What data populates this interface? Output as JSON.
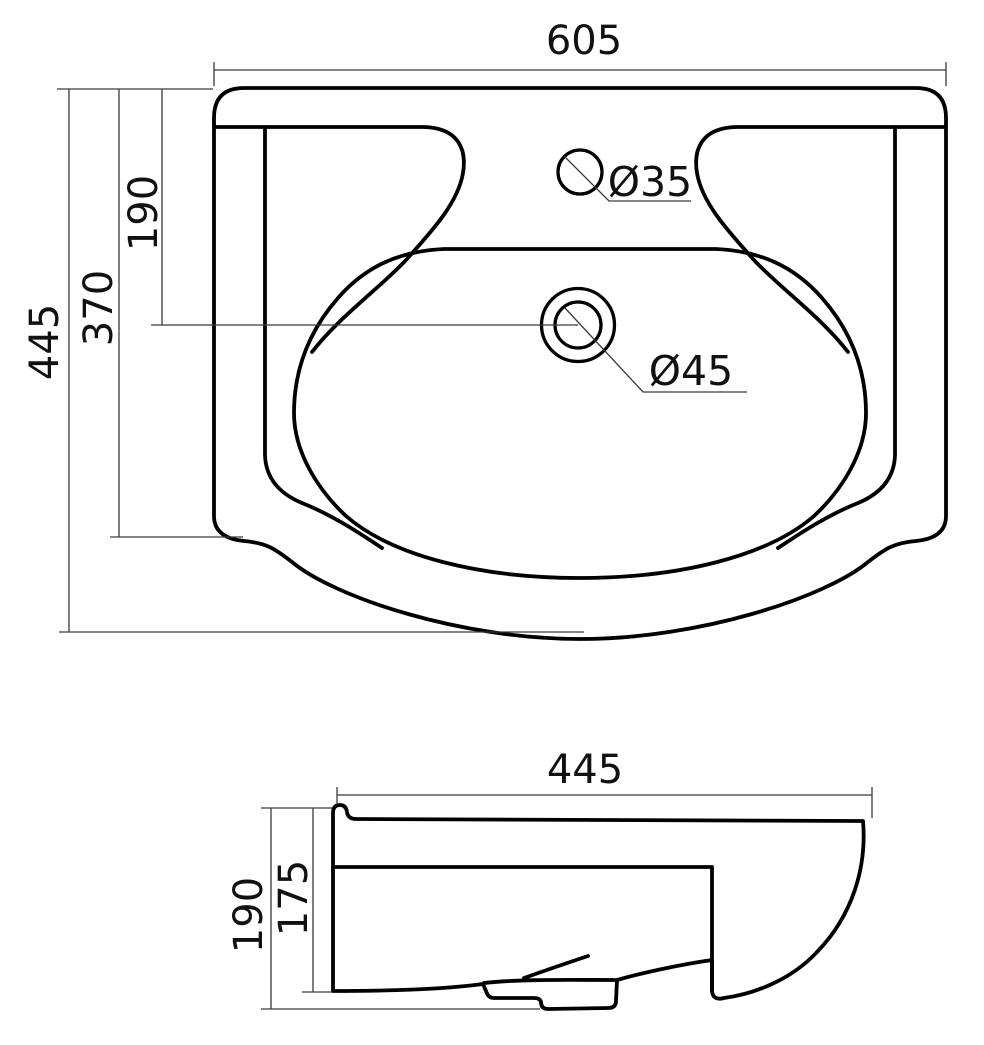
{
  "drawing": {
    "description": "Washbasin technical dimension drawing, two orthographic views",
    "background_color": "#ffffff",
    "outline_color": "#000000",
    "dimension_line_color": "#3a3a3a"
  },
  "top_view": {
    "name": "top view (plan) of washbasin",
    "dim_overall_width": "605",
    "dim_overall_depth": "445",
    "dim_front_edge_depth": "370",
    "dim_drain_center_offset": "190",
    "label_faucet_hole_diameter": "Ø35",
    "label_drain_hole_diameter": "Ø45"
  },
  "side_view": {
    "name": "side profile view of washbasin",
    "dim_depth": "445",
    "dim_overall_height": "190",
    "dim_bowl_height": "175"
  }
}
